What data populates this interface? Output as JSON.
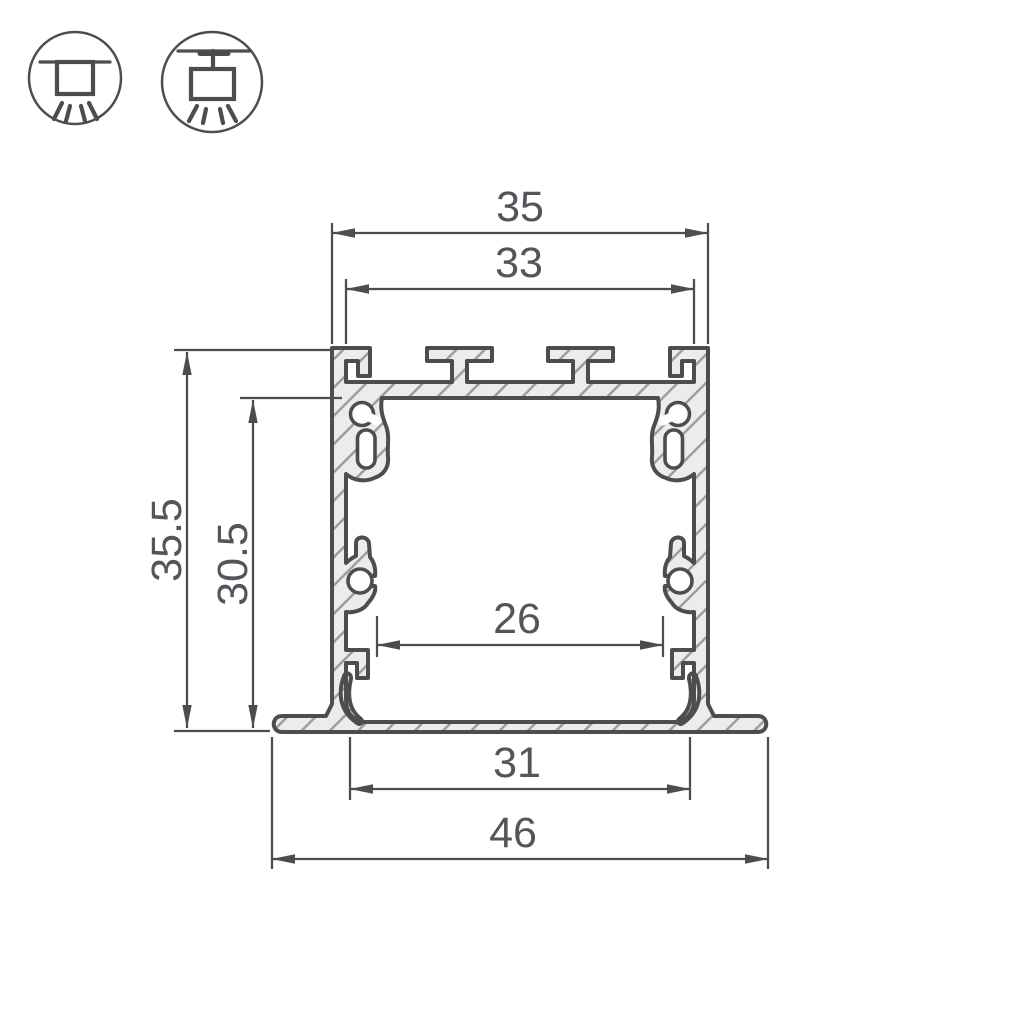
{
  "drawing": {
    "dimensions": {
      "top_outer_width": "35",
      "top_inner_width": "33",
      "outer_height": "35.5",
      "inner_height": "30.5",
      "inner_width": "26",
      "bottom_inner_width": "31",
      "overall_width": "46"
    },
    "icons": [
      {
        "name": "recessed-mount-icon"
      },
      {
        "name": "surface-mount-icon"
      }
    ],
    "colors": {
      "line": "#4d4d4f",
      "text": "#54555a",
      "metal_fill": "#ececec",
      "hatch": "#9a9a9a",
      "background": "#ffffff"
    }
  }
}
